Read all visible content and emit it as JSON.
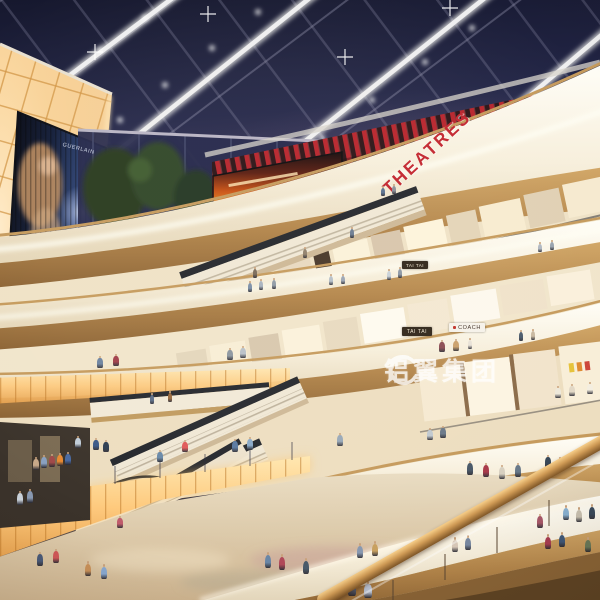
{
  "scene": {
    "description": "Multi-level shopping mall atrium interior rendering at evening, skylight roof, curved balconies, escalators and shoppers",
    "watermark": {
      "logo": "swirl-logo",
      "text": "铝翼集团"
    },
    "signs": {
      "theatres": "THEATRES",
      "tai_tai_upper": "TAI TAI",
      "tai_tai_lower": "TAI TAI",
      "coach": "COACH",
      "billboard_brand": "GUERLAIN"
    },
    "colors": {
      "sky": "#232548",
      "accent_red": "#b5232c",
      "warm_wall": "#f6cf96",
      "wood": "#b3854a",
      "fascia": "#f7efdc",
      "floor": "#dcc9a9",
      "glow": "#fec97c"
    },
    "people": [
      [
        383,
        196,
        10,
        "#59708f"
      ],
      [
        394,
        194,
        10,
        "#8a8f99"
      ],
      [
        250,
        292,
        11,
        "#7b8fa8"
      ],
      [
        261,
        290,
        11,
        "#a8b2bf"
      ],
      [
        274,
        289,
        11,
        "#8f9aa6"
      ],
      [
        331,
        285,
        11,
        "#b5bfc9"
      ],
      [
        343,
        284,
        10,
        "#9aa5b5"
      ],
      [
        389,
        280,
        11,
        "#c9d2da"
      ],
      [
        400,
        278,
        11,
        "#8c97a5"
      ],
      [
        540,
        252,
        10,
        "#b0b8c2"
      ],
      [
        552,
        250,
        10,
        "#98a2ae"
      ],
      [
        352,
        238,
        11,
        "#6c7c92"
      ],
      [
        305,
        258,
        11,
        "#90806c"
      ],
      [
        255,
        278,
        11,
        "#7a6a58"
      ],
      [
        100,
        368,
        12,
        "#6c82a0"
      ],
      [
        116,
        366,
        12,
        "#a03c48"
      ],
      [
        230,
        360,
        12,
        "#8c96a0"
      ],
      [
        243,
        358,
        12,
        "#b8c0c8"
      ],
      [
        442,
        352,
        12,
        "#8a4a52"
      ],
      [
        456,
        351,
        12,
        "#caa06a"
      ],
      [
        470,
        349,
        11,
        "#e8e2d8"
      ],
      [
        521,
        341,
        11,
        "#4a5a6c"
      ],
      [
        533,
        340,
        11,
        "#c8b8a0"
      ],
      [
        152,
        404,
        11,
        "#5a6c88"
      ],
      [
        170,
        402,
        11,
        "#98683c"
      ],
      [
        160,
        462,
        12,
        "#6888a8"
      ],
      [
        185,
        452,
        12,
        "#e05858"
      ],
      [
        120,
        528,
        12,
        "#c05a6a"
      ],
      [
        36,
        470,
        13,
        "#c8a888"
      ],
      [
        44,
        468,
        13,
        "#88a0c0"
      ],
      [
        52,
        467,
        13,
        "#a04848"
      ],
      [
        60,
        466,
        13,
        "#e88830"
      ],
      [
        68,
        465,
        13,
        "#4868a0"
      ],
      [
        20,
        505,
        14,
        "#c8d0d8"
      ],
      [
        30,
        503,
        14,
        "#8898b0"
      ],
      [
        78,
        448,
        12,
        "#c0ccd8"
      ],
      [
        96,
        450,
        12,
        "#3c5a88"
      ],
      [
        106,
        452,
        12,
        "#2e3e52"
      ],
      [
        235,
        452,
        13,
        "#5878a0"
      ],
      [
        250,
        450,
        13,
        "#88a8c8"
      ],
      [
        340,
        446,
        13,
        "#98a8b8"
      ],
      [
        430,
        440,
        12,
        "#c0c8d0"
      ],
      [
        443,
        438,
        12,
        "#6a7888"
      ],
      [
        470,
        475,
        14,
        "#485868"
      ],
      [
        486,
        477,
        14,
        "#a83848"
      ],
      [
        502,
        479,
        14,
        "#d8d0c0"
      ],
      [
        518,
        477,
        14,
        "#687888"
      ],
      [
        548,
        468,
        13,
        "#384858"
      ],
      [
        560,
        470,
        13,
        "#8898a8"
      ],
      [
        566,
        520,
        15,
        "#88b0d0"
      ],
      [
        579,
        522,
        15,
        "#c8c0b0"
      ],
      [
        592,
        519,
        15,
        "#3a4a5c"
      ],
      [
        540,
        528,
        14,
        "#a85868"
      ],
      [
        268,
        568,
        16,
        "#6a86a6"
      ],
      [
        282,
        570,
        16,
        "#b04858"
      ],
      [
        306,
        574,
        16,
        "#4a5a6a"
      ],
      [
        360,
        558,
        15,
        "#8898b0"
      ],
      [
        375,
        556,
        15,
        "#c8a060"
      ],
      [
        455,
        552,
        15,
        "#d8c8b8"
      ],
      [
        468,
        550,
        15,
        "#7888a0"
      ],
      [
        548,
        549,
        15,
        "#a83c50"
      ],
      [
        562,
        547,
        15,
        "#405878"
      ],
      [
        588,
        552,
        15,
        "#687858"
      ],
      [
        352,
        596,
        17,
        "#5a6a88"
      ],
      [
        368,
        598,
        17,
        "#b8c0d0"
      ],
      [
        88,
        576,
        15,
        "#c89058"
      ],
      [
        104,
        579,
        15,
        "#88a8d0"
      ],
      [
        40,
        566,
        14,
        "#4a5a78"
      ],
      [
        56,
        563,
        14,
        "#d05858"
      ],
      [
        558,
        398,
        12,
        "#eee8da"
      ],
      [
        572,
        396,
        12,
        "#e2d8c6"
      ],
      [
        590,
        394,
        12,
        "#f4eee0"
      ]
    ]
  }
}
